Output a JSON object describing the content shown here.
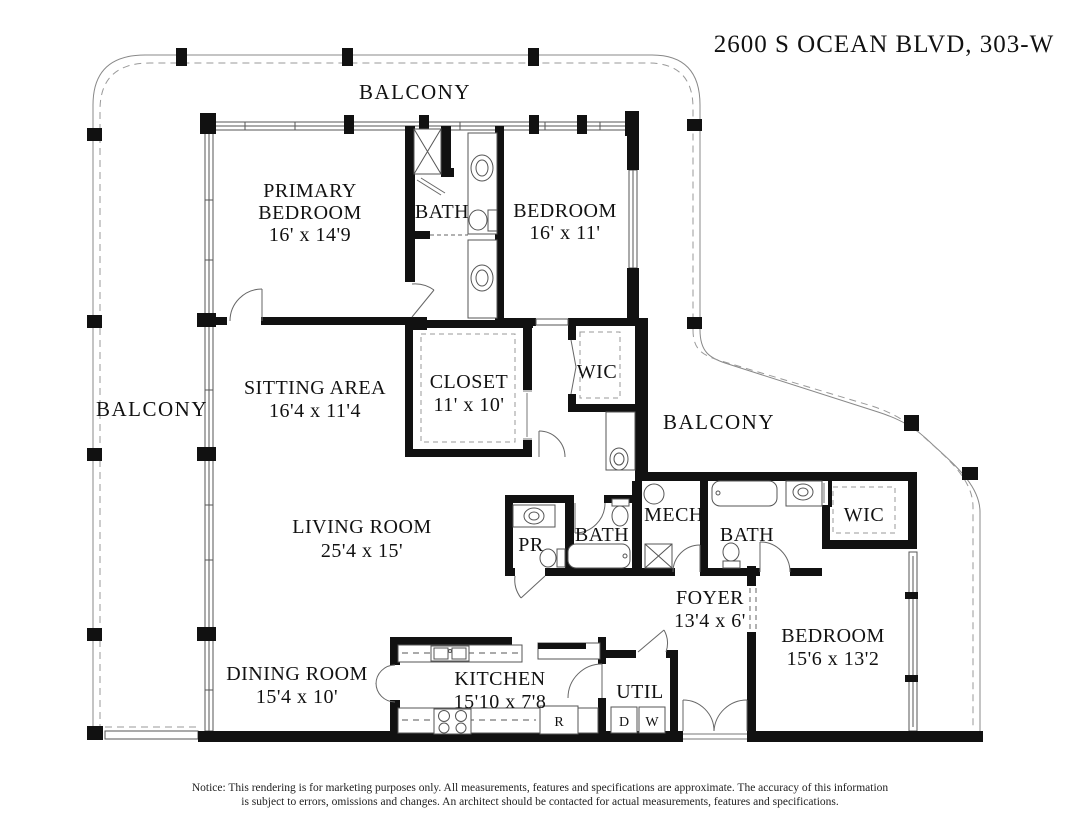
{
  "title": "2600 S OCEAN BLVD, 303-W",
  "labels": {
    "balconyTop": "BALCONY",
    "balconyLeft": "BALCONY",
    "balconyRight": "BALCONY",
    "primaryBedroom": {
      "l1": "PRIMARY",
      "l2": "BEDROOM",
      "dims": "16' x 14'9"
    },
    "bathPrimary": "BATH",
    "bedroom2": {
      "name": "BEDROOM",
      "dims": "16' x 11'"
    },
    "sittingArea": {
      "name": "SITTING AREA",
      "dims": "16'4 x 11'4"
    },
    "closet": {
      "name": "CLOSET",
      "dims": "11' x 10'"
    },
    "wic1": "WIC",
    "livingRoom": {
      "name": "LIVING ROOM",
      "dims": "25'4 x 15'"
    },
    "pr": "PR",
    "bath2": "BATH",
    "mech": "MECH",
    "bath3": "BATH",
    "wic2": "WIC",
    "foyer": {
      "name": "FOYER",
      "dims": "13'4 x 6'"
    },
    "bedroom3": {
      "name": "BEDROOM",
      "dims": "15'6 x 13'2"
    },
    "diningRoom": {
      "name": "DINING ROOM",
      "dims": "15'4 x 10'"
    },
    "kitchen": {
      "name": "KITCHEN",
      "dims": "15'10 x 7'8"
    },
    "util": "UTIL",
    "dryer": "D",
    "washer": "W",
    "refrigerator": "R"
  },
  "notice": {
    "line1": "Notice: This rendering is for marketing purposes only. All measurements, features and specifications are approximate. The accuracy of this information",
    "line2": "is subject to errors, omissions and changes. An architect should be contacted for actual measurements, features and specifications."
  },
  "colors": {
    "background": "#ffffff",
    "walls": "#111111",
    "thin_lines": "#555555",
    "balcony_lines": "#888888",
    "text": "#111111"
  }
}
